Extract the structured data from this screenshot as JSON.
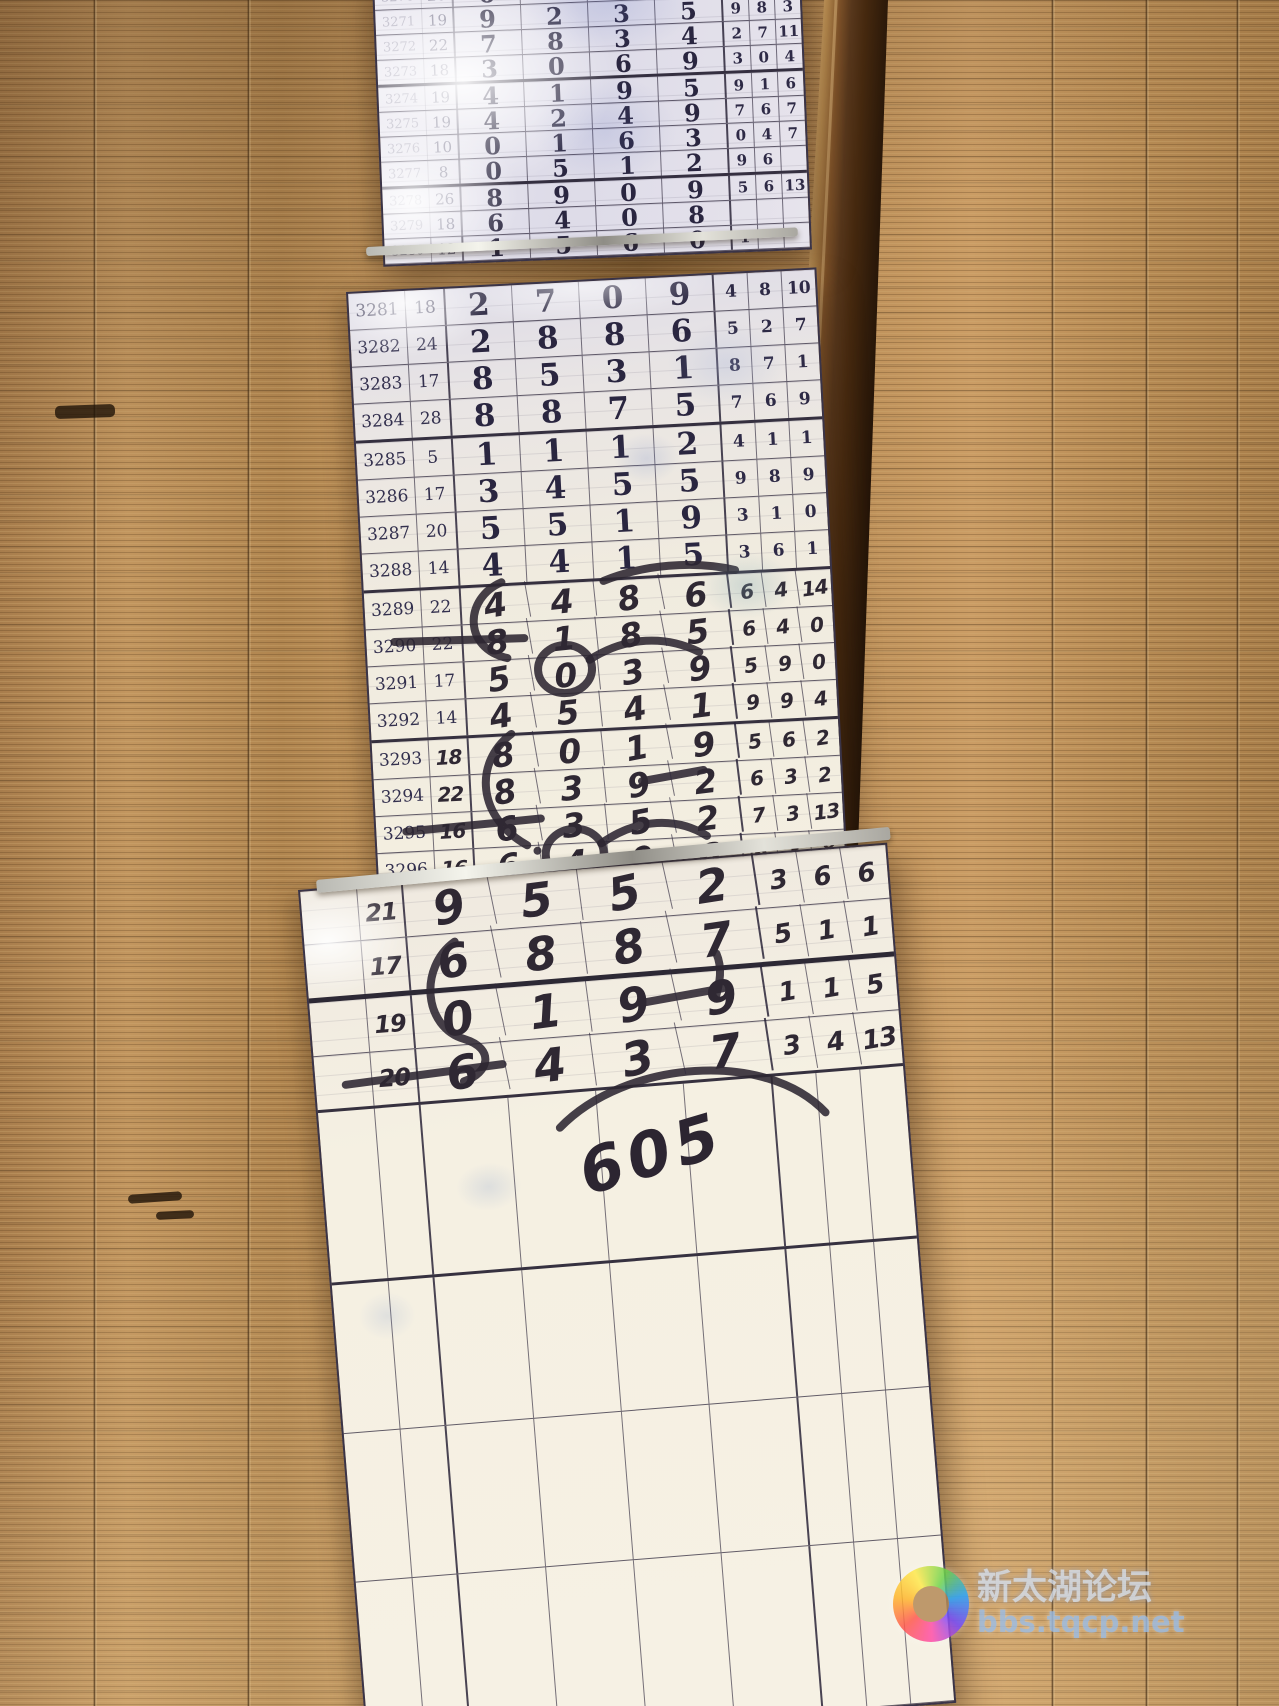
{
  "panels": {
    "top": {
      "rows": [
        {
          "id": "3270",
          "sum": "26",
          "digits": [
            "6",
            "4",
            "9",
            "7"
          ],
          "right": [
            "1",
            "0",
            "0"
          ]
        },
        {
          "id": "3271",
          "sum": "19",
          "digits": [
            "9",
            "2",
            "3",
            "5"
          ],
          "right": [
            "9",
            "8",
            "3"
          ]
        },
        {
          "id": "3272",
          "sum": "22",
          "digits": [
            "7",
            "8",
            "3",
            "4"
          ],
          "right": [
            "2",
            "7",
            "11"
          ]
        },
        {
          "id": "3273",
          "sum": "18",
          "digits": [
            "3",
            "0",
            "6",
            "9"
          ],
          "right": [
            "3",
            "0",
            "4"
          ]
        },
        {
          "id": "3274",
          "sum": "19",
          "digits": [
            "4",
            "1",
            "9",
            "5"
          ],
          "right": [
            "9",
            "1",
            "6"
          ]
        },
        {
          "id": "3275",
          "sum": "19",
          "digits": [
            "4",
            "2",
            "4",
            "9"
          ],
          "right": [
            "7",
            "6",
            "7"
          ]
        },
        {
          "id": "3276",
          "sum": "10",
          "digits": [
            "0",
            "1",
            "6",
            "3"
          ],
          "right": [
            "0",
            "4",
            "7"
          ]
        },
        {
          "id": "3277",
          "sum": "8",
          "digits": [
            "0",
            "5",
            "1",
            "2"
          ],
          "right": [
            "9",
            "6",
            ""
          ]
        },
        {
          "id": "3278",
          "sum": "26",
          "digits": [
            "8",
            "9",
            "0",
            "9"
          ],
          "right": [
            "5",
            "6",
            "13"
          ]
        },
        {
          "id": "3279",
          "sum": "18",
          "digits": [
            "6",
            "4",
            "0",
            "8"
          ],
          "right": [
            "",
            "",
            ""
          ]
        },
        {
          "id": "3280",
          "sum": "12",
          "digits": [
            "1",
            "5",
            "6",
            "0"
          ],
          "right": [
            "1",
            "",
            ""
          ]
        }
      ]
    },
    "middle": {
      "rows": [
        {
          "id": "3281",
          "sum": "18",
          "digits": [
            "2",
            "7",
            "0",
            "9"
          ],
          "right": [
            "4",
            "8",
            "10"
          ]
        },
        {
          "id": "3282",
          "sum": "24",
          "digits": [
            "2",
            "8",
            "8",
            "6"
          ],
          "right": [
            "5",
            "2",
            "7"
          ]
        },
        {
          "id": "3283",
          "sum": "17",
          "digits": [
            "8",
            "5",
            "3",
            "1"
          ],
          "right": [
            "8",
            "7",
            "1"
          ]
        },
        {
          "id": "3284",
          "sum": "28",
          "digits": [
            "8",
            "8",
            "7",
            "5"
          ],
          "right": [
            "7",
            "6",
            "9"
          ]
        },
        {
          "id": "3285",
          "sum": "5",
          "digits": [
            "1",
            "1",
            "1",
            "2"
          ],
          "right": [
            "4",
            "1",
            "1"
          ]
        },
        {
          "id": "3286",
          "sum": "17",
          "digits": [
            "3",
            "4",
            "5",
            "5"
          ],
          "right": [
            "9",
            "8",
            "9"
          ]
        },
        {
          "id": "3287",
          "sum": "20",
          "digits": [
            "5",
            "5",
            "1",
            "9"
          ],
          "right": [
            "3",
            "1",
            "0"
          ]
        },
        {
          "id": "3288",
          "sum": "14",
          "digits": [
            "4",
            "4",
            "1",
            "5"
          ],
          "right": [
            "3",
            "6",
            "1"
          ]
        },
        {
          "id": "3289",
          "sum": "22",
          "digits": [
            "4",
            "4",
            "8",
            "6"
          ],
          "right": [
            "6",
            "4",
            "14"
          ],
          "hand": true
        },
        {
          "id": "3290",
          "sum": "22",
          "digits": [
            "8",
            "1",
            "8",
            "5"
          ],
          "right": [
            "6",
            "4",
            "0"
          ],
          "hand": true
        },
        {
          "id": "3291",
          "sum": "17",
          "digits": [
            "5",
            "0",
            "3",
            "9"
          ],
          "right": [
            "5",
            "9",
            "0"
          ],
          "hand": true
        },
        {
          "id": "3292",
          "sum": "14",
          "digits": [
            "4",
            "5",
            "4",
            "1"
          ],
          "right": [
            "9",
            "9",
            "4"
          ],
          "hand": true
        },
        {
          "id": "3293",
          "sum": "18",
          "digits": [
            "8",
            "0",
            "1",
            "9"
          ],
          "right": [
            "5",
            "6",
            "2"
          ],
          "hand": true,
          "sumHand": true
        },
        {
          "id": "3294",
          "sum": "22",
          "digits": [
            "8",
            "3",
            "9",
            "2"
          ],
          "right": [
            "6",
            "3",
            "2"
          ],
          "hand": true,
          "sumHand": true
        },
        {
          "id": "3295",
          "sum": "16",
          "digits": [
            "6",
            "3",
            "5",
            "2"
          ],
          "right": [
            "7",
            "3",
            "13"
          ],
          "hand": true,
          "sumHand": true
        },
        {
          "id": "3296",
          "sum": "16",
          "digits": [
            "6",
            "4",
            "0",
            "6"
          ],
          "right": [
            "6",
            "8",
            "8"
          ],
          "hand": true,
          "sumHand": true
        }
      ]
    },
    "bottom": {
      "rows": [
        {
          "id": "",
          "sum": "21",
          "digits": [
            "9",
            "5",
            "5",
            "2"
          ],
          "right": [
            "3",
            "6",
            "6"
          ],
          "hand": true,
          "sumHand": true
        },
        {
          "id": "",
          "sum": "17",
          "digits": [
            "6",
            "8",
            "8",
            "7"
          ],
          "right": [
            "5",
            "1",
            "1"
          ],
          "hand": true,
          "sumHand": true
        },
        {
          "id": "",
          "sum": "19",
          "digits": [
            "0",
            "1",
            "9",
            "9"
          ],
          "right": [
            "1",
            "1",
            "5"
          ],
          "hand": true,
          "sumHand": true
        },
        {
          "id": "",
          "sum": "20",
          "digits": [
            "6",
            "4",
            "3",
            "7"
          ],
          "right": [
            "3",
            "4",
            "13"
          ],
          "hand": true,
          "sumHand": true
        }
      ],
      "empty_row_count": 4
    }
  },
  "annotations": {
    "note": "605"
  },
  "watermark": {
    "line1": "新太湖论坛",
    "line2": "bbs.tqcp.net"
  }
}
